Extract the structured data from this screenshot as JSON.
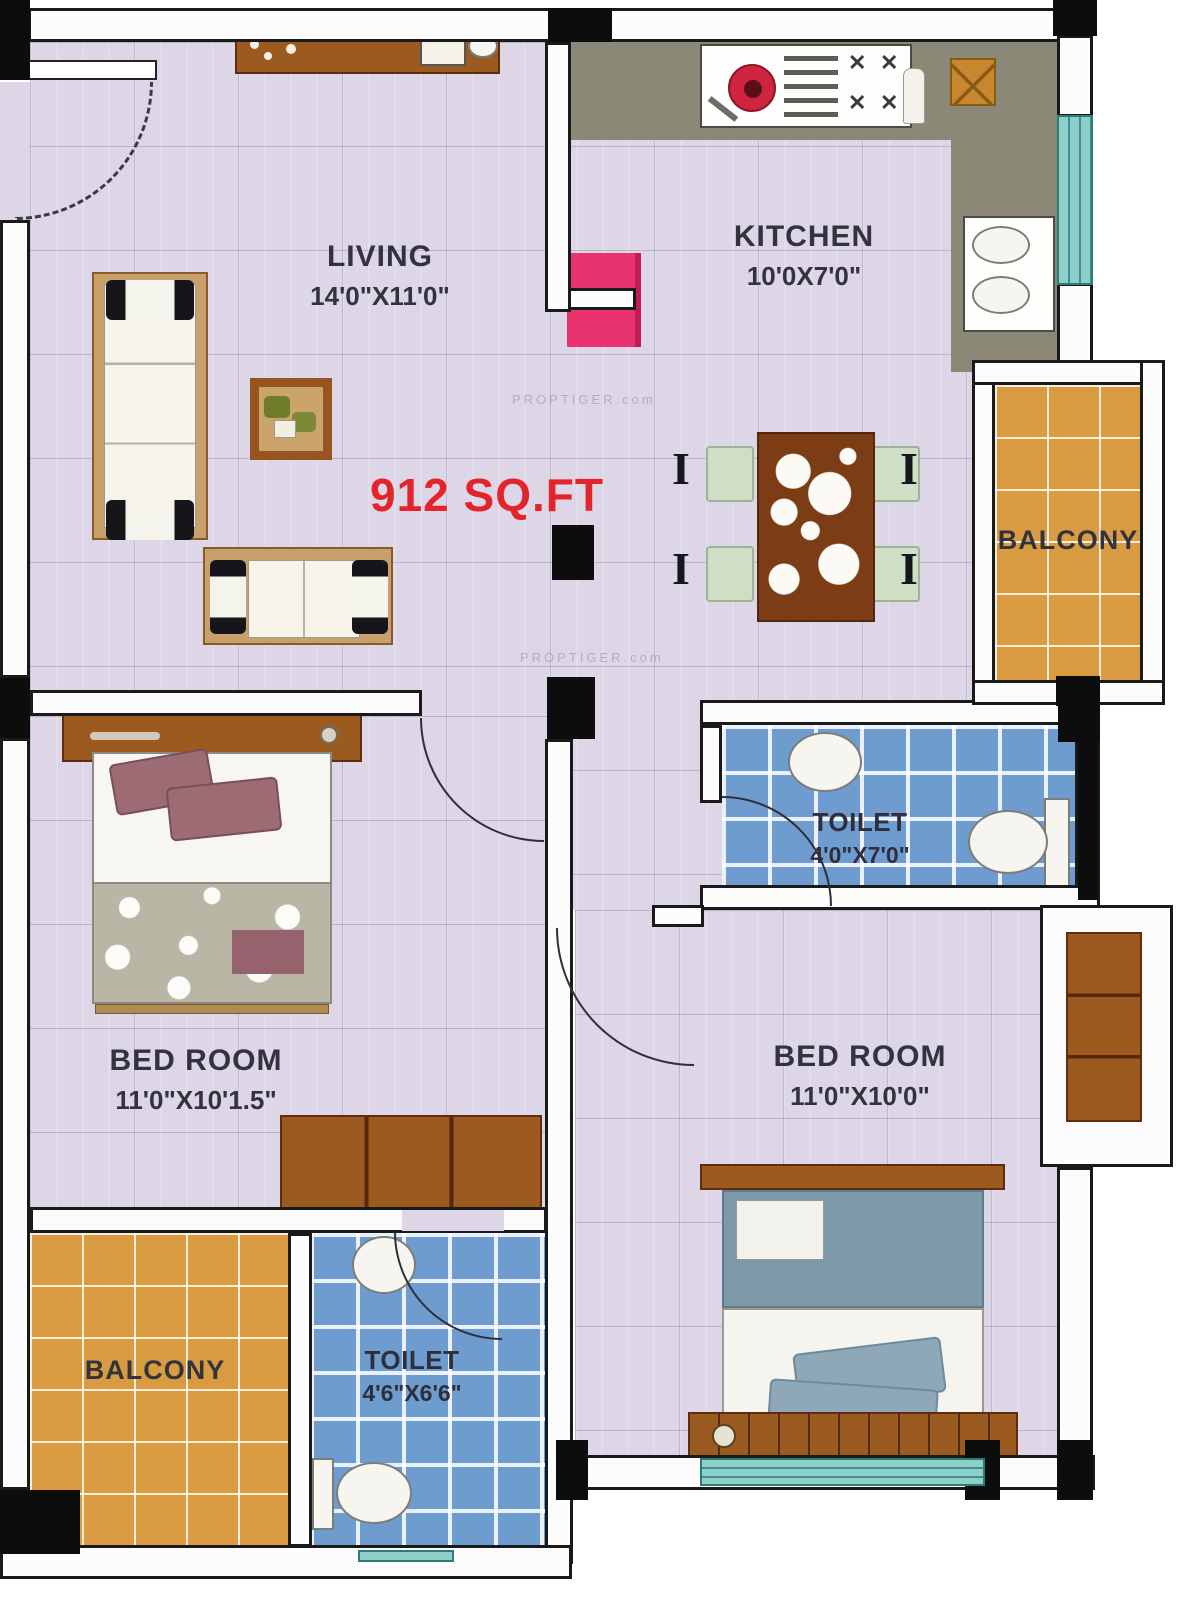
{
  "plan": {
    "area_label": "912 SQ.FT",
    "watermark": "PROPTIGER.com",
    "rooms": {
      "living": {
        "name": "LIVING",
        "dims": "14'0\"X11'0\""
      },
      "kitchen": {
        "name": "KITCHEN",
        "dims": "10'0X7'0\""
      },
      "balcony_right": {
        "name": "BALCONY"
      },
      "toilet_right": {
        "name": "TOILET",
        "dims": "4'0\"X7'0\""
      },
      "bedroom_left": {
        "name": "BED ROOM",
        "dims": "11'0\"X10'1.5\""
      },
      "bedroom_right": {
        "name": "BED ROOM",
        "dims": "11'0\"X10'0\""
      },
      "balcony_bottom": {
        "name": "BALCONY"
      },
      "toilet_bottom": {
        "name": "TOILET",
        "dims": "4'6\"X6'6\""
      }
    },
    "colors": {
      "area_text": "#e3242b",
      "floor": "#dcd6e6",
      "balcony_floor": "#d89b41",
      "toilet_floor": "#6f9ccf",
      "kitchen_counter": "#8b8877",
      "fridge": "#e8336f",
      "window": "#8ecfcb",
      "wood": "#8a4a1d"
    }
  }
}
